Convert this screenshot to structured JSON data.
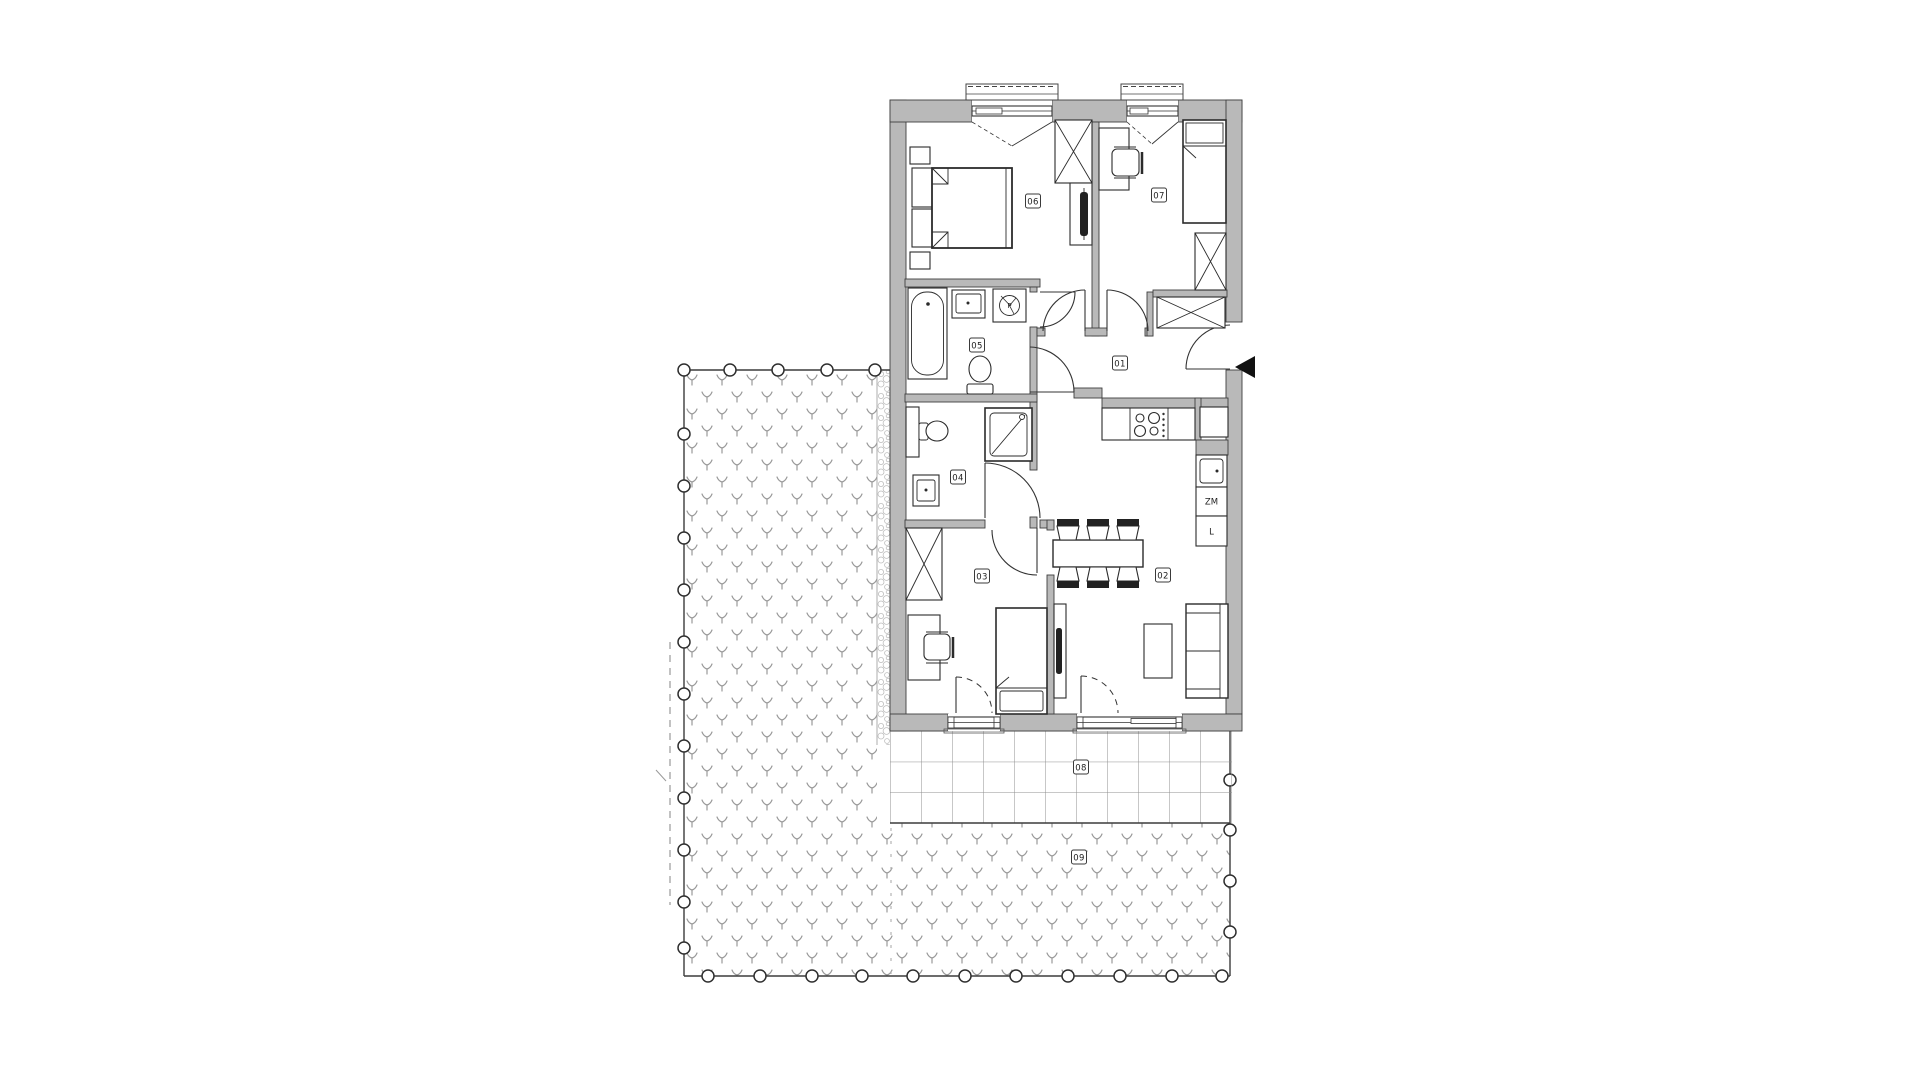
{
  "floor_plan": {
    "room_labels": [
      {
        "label": "01"
      },
      {
        "label": "02"
      },
      {
        "label": "03"
      },
      {
        "label": "04"
      },
      {
        "label": "05"
      },
      {
        "label": "06"
      },
      {
        "label": "07"
      },
      {
        "label": "08"
      },
      {
        "label": "09"
      }
    ],
    "kitchen": {
      "dishwasher_label": "ZM",
      "fridge_label": "L"
    },
    "bathroom": {
      "washing_machine_label": "P"
    },
    "colors": {
      "wall_fill": "#b9b9b9",
      "outline": "#333333",
      "pattern_gray": "#9a9a9a",
      "entry_marker": "#111111"
    }
  }
}
